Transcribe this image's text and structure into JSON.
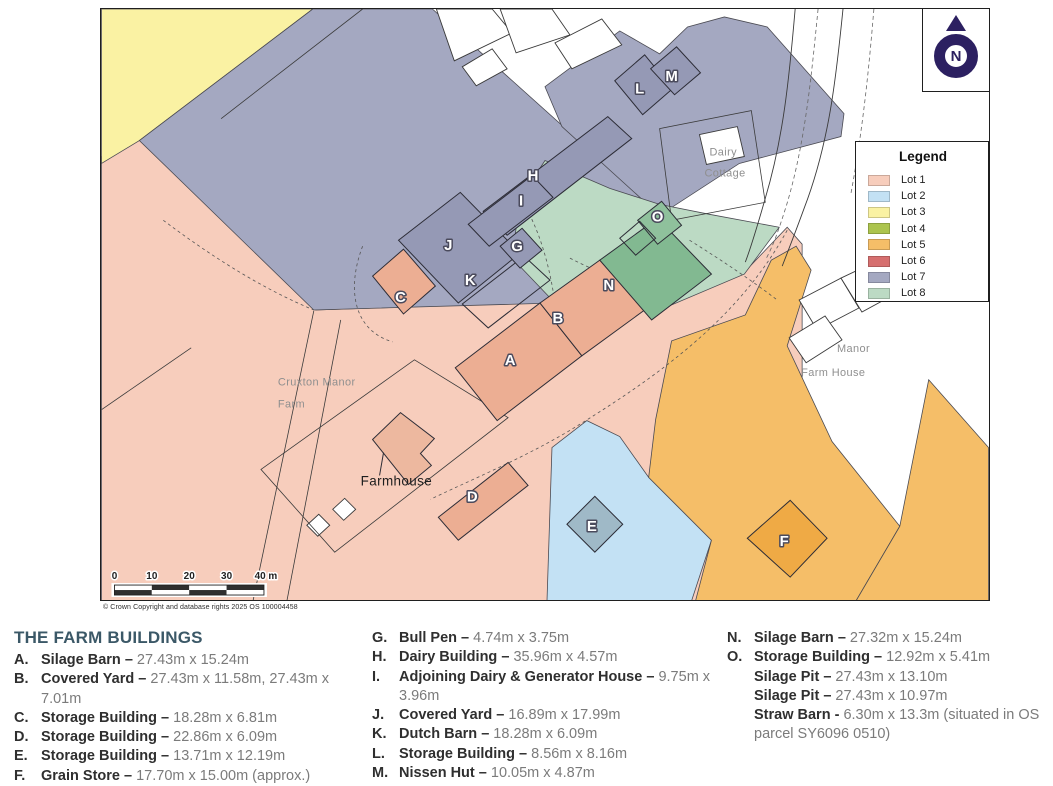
{
  "colors": {
    "lot1": "#F7CDBC",
    "lot2": "#C3E1F4",
    "lot3": "#FAF2A3",
    "lot4": "#ACC44E",
    "lot5": "#F5BE68",
    "lot6": "#D66F6F",
    "lot7": "#A4A8C1",
    "lot8": "#BCDAC4",
    "building_salmon": "#ECAE93",
    "building_farmhouse": "#EDB89F",
    "building_grey": "#9599B5",
    "building_green": "#82B991",
    "building_green_small": "#8FC19C",
    "building_blue": "#9FB9C7",
    "building_orange": "#EFAA45",
    "north_indigo": "#2c2061"
  },
  "map": {
    "letters": [
      "A",
      "B",
      "C",
      "D",
      "E",
      "F",
      "G",
      "H",
      "I",
      "J",
      "K",
      "L",
      "M",
      "N",
      "O"
    ],
    "labels": {
      "cruxton_line1": "Cruxton Manor",
      "cruxton_line2": "Farm",
      "farmhouse": "Farmhouse",
      "dairy_line1": "Dairy",
      "dairy_line2": "Cottage",
      "manor_line1": "Manor",
      "manor_line2": "Farm House"
    },
    "scale_ticks": [
      "0",
      "10",
      "20",
      "30",
      "40 m"
    ],
    "copyright": "© Crown Copyright and database rights 2025 OS 100004458",
    "north_label": "N"
  },
  "legend": {
    "title": "Legend",
    "items": [
      {
        "label": "Lot 1",
        "color": "#F7CDBC"
      },
      {
        "label": "Lot 2",
        "color": "#C3E1F4"
      },
      {
        "label": "Lot 3",
        "color": "#FAF2A3"
      },
      {
        "label": "Lot 4",
        "color": "#ACC44E"
      },
      {
        "label": "Lot 5",
        "color": "#F5BE68"
      },
      {
        "label": "Lot 6",
        "color": "#D66F6F"
      },
      {
        "label": "Lot 7",
        "color": "#A4A8C1"
      },
      {
        "label": "Lot 8",
        "color": "#BCDAC4"
      }
    ]
  },
  "farm_buildings": {
    "title": "THE FARM BUILDINGS",
    "col1": [
      {
        "letter": "A.",
        "name": "Silage Barn",
        "sep": "–",
        "dims": "27.43m x 15.24m"
      },
      {
        "letter": "B.",
        "name": "Covered Yard",
        "sep": "–",
        "dims": "27.43m x 11.58m, 27.43m x 7.01m"
      },
      {
        "letter": "C.",
        "name": "Storage Building",
        "sep": "–",
        "dims": "18.28m x 6.81m"
      },
      {
        "letter": "D.",
        "name": "Storage Building",
        "sep": "–",
        "dims": "22.86m x 6.09m"
      },
      {
        "letter": "E.",
        "name": "Storage Building",
        "sep": "–",
        "dims": "13.71m x 12.19m"
      },
      {
        "letter": "F.",
        "name": "Grain Store",
        "sep": "–",
        "dims": "17.70m x 15.00m (approx.)"
      }
    ],
    "col2": [
      {
        "letter": "G.",
        "name": "Bull Pen",
        "sep": "–",
        "dims": "4.74m x 3.75m"
      },
      {
        "letter": "H.",
        "name": "Dairy Building",
        "sep": "–",
        "dims": "35.96m x 4.57m"
      },
      {
        "letter": "I.",
        "name": "Adjoining Dairy & Generator House",
        "sep": "–",
        "dims": "9.75m x 3.96m"
      },
      {
        "letter": "J.",
        "name": "Covered Yard",
        "sep": "–",
        "dims": "16.89m x 17.99m"
      },
      {
        "letter": "K.",
        "name": "Dutch Barn",
        "sep": "–",
        "dims": "18.28m x 6.09m"
      },
      {
        "letter": "L.",
        "name": "Storage Building",
        "sep": "–",
        "dims": "8.56m x 8.16m"
      },
      {
        "letter": "M.",
        "name": "Nissen Hut",
        "sep": "–",
        "dims": "10.05m x 4.87m"
      }
    ],
    "col3": [
      {
        "letter": "N.",
        "name": "Silage Barn",
        "sep": "–",
        "dims": "27.32m x 15.24m"
      },
      {
        "letter": "O.",
        "name": "Storage Building",
        "sep": "–",
        "dims": "12.92m x 5.41m"
      },
      {
        "letter": "",
        "name": "Silage Pit",
        "sep": "–",
        "dims": "27.43m x 13.10m"
      },
      {
        "letter": "",
        "name": "Silage Pit",
        "sep": "–",
        "dims": "27.43m x 10.97m"
      },
      {
        "letter": "",
        "name": "Straw Barn",
        "sep": "-",
        "dims": "6.30m x 13.3m (situated in OS parcel SY6096 0510)"
      }
    ]
  }
}
